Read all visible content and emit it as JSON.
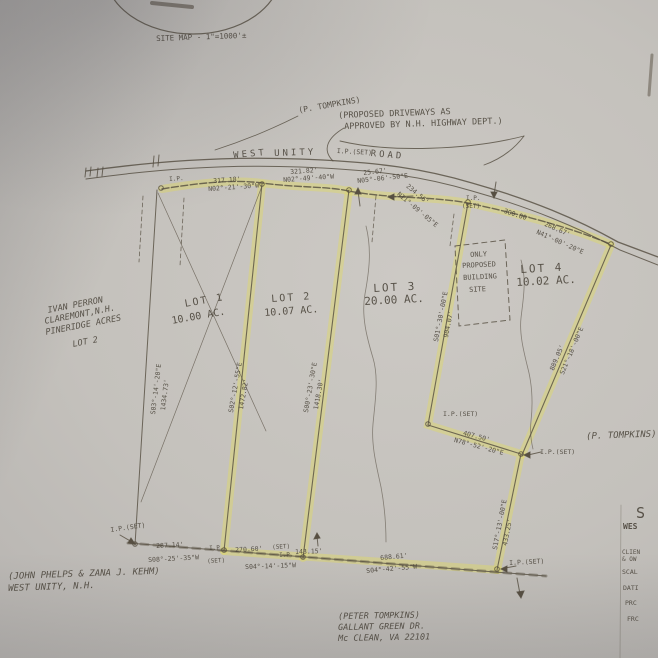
{
  "document": {
    "kind": "scanned land survey plat (photo of paper drawing)",
    "road_name": "WEST UNITY ROAD",
    "site_map_scale": "SITE MAP - 1\"=1000'±",
    "highlight_color": "#ddd76e",
    "ink_color": "#574f42",
    "lots": [
      {
        "lot": "LOT 1",
        "area": "10.00 AC."
      },
      {
        "lot": "LOT 2",
        "area": "10.07 AC."
      },
      {
        "lot": "LOT 3",
        "area": "20.00 AC."
      },
      {
        "lot": "LOT 4",
        "area": "10.02 AC."
      }
    ]
  },
  "labels": [
    {
      "name": "site-map-caption",
      "text": "SITE MAP - 1\"=1000'±",
      "x": 156,
      "y": 35,
      "rot": -2,
      "size": 7.5
    },
    {
      "name": "tompkins-note-top",
      "text": "(P. TOMPKINS)",
      "x": 298,
      "y": 107,
      "rot": -10,
      "size": 8
    },
    {
      "name": "driveway-note-line1",
      "text": "(PROPOSED DRIVEWAYS AS",
      "x": 338,
      "y": 112,
      "rot": -2,
      "size": 8.5
    },
    {
      "name": "driveway-note-line2",
      "text": "APPROVED BY N.H. HIGHWAY DEPT.)",
      "x": 344,
      "y": 123,
      "rot": -2,
      "size": 8.5
    },
    {
      "name": "road-label-west",
      "text": "WEST",
      "x": 233,
      "y": 152,
      "rot": -5,
      "size": 9,
      "cls": "ls3"
    },
    {
      "name": "road-label-unity",
      "text": "UNITY",
      "x": 274,
      "y": 150,
      "rot": -2,
      "size": 9,
      "cls": "ls3"
    },
    {
      "name": "road-ip-set",
      "text": "I.P.(SET)",
      "x": 337,
      "y": 148,
      "rot": 3,
      "size": 6.5
    },
    {
      "name": "road-label-road",
      "text": "ROAD",
      "x": 371,
      "y": 150,
      "rot": 5,
      "size": 9,
      "cls": "ls3"
    },
    {
      "name": "ip-marker-label",
      "text": "I.P.",
      "x": 169,
      "y": 177,
      "rot": -4,
      "size": 6
    },
    {
      "name": "frontage-dim-1",
      "text": "317.18'",
      "x": 213,
      "y": 178,
      "rot": -4,
      "size": 6.5
    },
    {
      "name": "frontage-brg-1",
      "text": "N02°-21'-30\"W",
      "x": 208,
      "y": 186,
      "rot": -4,
      "size": 6.5
    },
    {
      "name": "frontage-dim-2",
      "text": "321.82'",
      "x": 290,
      "y": 169,
      "rot": -4,
      "size": 6.5
    },
    {
      "name": "frontage-brg-2",
      "text": "N02°-49'-40\"W",
      "x": 283,
      "y": 177,
      "rot": -4,
      "size": 6.5
    },
    {
      "name": "frontage-dim-3",
      "text": "25.67'",
      "x": 363,
      "y": 170,
      "rot": -6,
      "size": 6.5
    },
    {
      "name": "frontage-brg-3",
      "text": "N05°-06'-50\"E",
      "x": 357,
      "y": 178,
      "rot": -6,
      "size": 6.5
    },
    {
      "name": "frontage-dim-4",
      "text": "234.56'",
      "x": 409,
      "y": 183,
      "rot": 40,
      "size": 6.5
    },
    {
      "name": "frontage-brg-4",
      "text": "N11°-09'-05\"E",
      "x": 400,
      "y": 191,
      "rot": 40,
      "size": 6.5
    },
    {
      "name": "ip-marker-label",
      "text": "I.P.",
      "x": 466,
      "y": 196,
      "rot": 0,
      "size": 6
    },
    {
      "name": "ip-marker-label",
      "text": "(SET)",
      "x": 462,
      "y": 204,
      "rot": 0,
      "size": 6
    },
    {
      "name": "frontage-dim-5",
      "text": "300.00'",
      "x": 505,
      "y": 208,
      "rot": 18,
      "size": 6.5
    },
    {
      "name": "frontage-dim-6",
      "text": "268.67'",
      "x": 546,
      "y": 221,
      "rot": 24,
      "size": 6.5
    },
    {
      "name": "frontage-brg-6",
      "text": "N41°-00'-20\"E",
      "x": 538,
      "y": 229,
      "rot": 24,
      "size": 6.5
    },
    {
      "name": "lot1-title",
      "text": "LOT 1",
      "x": 184,
      "y": 300,
      "rot": -10,
      "size": 10,
      "cls": "ls2"
    },
    {
      "name": "lot1-area",
      "text": "10.00 AC.",
      "x": 171,
      "y": 317,
      "rot": -10,
      "size": 10
    },
    {
      "name": "lot2-title",
      "text": "LOT 2",
      "x": 271,
      "y": 295,
      "rot": -4,
      "size": 10,
      "cls": "ls2"
    },
    {
      "name": "lot2-area",
      "text": "10.07 AC.",
      "x": 264,
      "y": 309,
      "rot": -4,
      "size": 10
    },
    {
      "name": "lot3-title",
      "text": "LOT 3",
      "x": 373,
      "y": 283,
      "rot": -3,
      "size": 11,
      "cls": "ls2"
    },
    {
      "name": "lot3-area",
      "text": "20.00 AC.",
      "x": 364,
      "y": 296,
      "rot": -3,
      "size": 11
    },
    {
      "name": "building-site-line1",
      "text": "ONLY",
      "x": 470,
      "y": 252,
      "rot": -3,
      "size": 7
    },
    {
      "name": "building-site-line2",
      "text": "PROPOSED",
      "x": 462,
      "y": 263,
      "rot": -3,
      "size": 7
    },
    {
      "name": "building-site-line3",
      "text": "BUILDING",
      "x": 463,
      "y": 275,
      "rot": -3,
      "size": 7
    },
    {
      "name": "building-site-line4",
      "text": "SITE",
      "x": 469,
      "y": 287,
      "rot": -3,
      "size": 7
    },
    {
      "name": "lot4-title",
      "text": "LOT 4",
      "x": 520,
      "y": 264,
      "rot": -3,
      "size": 11,
      "cls": "ls2"
    },
    {
      "name": "lot4-area",
      "text": "10.02 AC.",
      "x": 516,
      "y": 277,
      "rot": -3,
      "size": 11
    },
    {
      "name": "abutter-perron-1",
      "text": "IVAN PERRON",
      "x": 47,
      "y": 307,
      "rot": -11,
      "size": 8.5,
      "cls": "i"
    },
    {
      "name": "abutter-perron-2",
      "text": "CLAREMONT,N.H.",
      "x": 44,
      "y": 318,
      "rot": -11,
      "size": 8.5,
      "cls": "i"
    },
    {
      "name": "abutter-perron-3",
      "text": "PINERIDGE ACRES",
      "x": 45,
      "y": 329,
      "rot": -11,
      "size": 8.5,
      "cls": "i"
    },
    {
      "name": "abutter-perron-4",
      "text": "LOT 2",
      "x": 72,
      "y": 341,
      "rot": -11,
      "size": 8.5,
      "cls": "i"
    },
    {
      "name": "west-line-brg",
      "text": "S03°-14'-20\"E",
      "x": 150,
      "y": 414,
      "rot": -83,
      "size": 6.5
    },
    {
      "name": "west-line-dim",
      "text": "1434.73'",
      "x": 160,
      "y": 410,
      "rot": -83,
      "size": 6.5
    },
    {
      "name": "lot2-west-brg",
      "text": "S02°-12'-55\"E",
      "x": 228,
      "y": 412,
      "rot": -80,
      "size": 6.5
    },
    {
      "name": "lot2-west-dim",
      "text": "1472.82'",
      "x": 238,
      "y": 409,
      "rot": -80,
      "size": 6.5
    },
    {
      "name": "lot3-west-brg",
      "text": "S00°-23'-30\"E",
      "x": 303,
      "y": 412,
      "rot": -80,
      "size": 6.5
    },
    {
      "name": "lot3-west-dim",
      "text": "1418.30'",
      "x": 313,
      "y": 409,
      "rot": -80,
      "size": 6.5
    },
    {
      "name": "lot3-east-brg",
      "text": "S01°-30'-00\"E",
      "x": 433,
      "y": 341,
      "rot": -79,
      "size": 6.5
    },
    {
      "name": "lot3-east-dim",
      "text": "904.07'",
      "x": 443,
      "y": 337,
      "rot": -79,
      "size": 6.5
    },
    {
      "name": "ip-set-label",
      "text": "I.P.(SET)",
      "x": 443,
      "y": 411,
      "rot": 0,
      "size": 6.5
    },
    {
      "name": "jog-dim",
      "text": "407.50'",
      "x": 464,
      "y": 430,
      "rot": 15,
      "size": 6.5
    },
    {
      "name": "jog-brg",
      "text": "N78°-52'-20\"E",
      "x": 455,
      "y": 437,
      "rot": 15,
      "size": 6.5
    },
    {
      "name": "ip-set-label",
      "text": "I.P.(SET)",
      "x": 540,
      "y": 449,
      "rot": 0,
      "size": 6.5
    },
    {
      "name": "lot4-east-dim",
      "text": "889.05'",
      "x": 549,
      "y": 369,
      "rot": -67,
      "size": 6.5
    },
    {
      "name": "lot4-east-brg",
      "text": "S21°-18'-00\"E",
      "x": 559,
      "y": 373,
      "rot": -67,
      "size": 6.5
    },
    {
      "name": "tompkins-note-right",
      "text": "(P. TOMPKINS)",
      "x": 586,
      "y": 433,
      "rot": -2,
      "size": 9,
      "cls": "i"
    },
    {
      "name": "segment-brg",
      "text": "S17°-13'-00\"E",
      "x": 492,
      "y": 549,
      "rot": -79,
      "size": 6.5
    },
    {
      "name": "segment-dim",
      "text": "433.25'",
      "x": 502,
      "y": 545,
      "rot": -79,
      "size": 6.5
    },
    {
      "name": "ip-set-label",
      "text": "I.P.(SET)",
      "x": 110,
      "y": 527,
      "rot": -8,
      "size": 6.5
    },
    {
      "name": "bottom-dim-1",
      "text": "287.14'",
      "x": 156,
      "y": 543,
      "rot": -3,
      "size": 6.5
    },
    {
      "name": "bottom-brg-1",
      "text": "S08°-25'-35\"W",
      "x": 148,
      "y": 557,
      "rot": -3,
      "size": 6.5
    },
    {
      "name": "ip-marker-label",
      "text": "I.P.",
      "x": 209,
      "y": 546,
      "rot": -3,
      "size": 6
    },
    {
      "name": "ip-marker-label",
      "text": "(SET)",
      "x": 207,
      "y": 559,
      "rot": -3,
      "size": 6
    },
    {
      "name": "bottom-dim-2",
      "text": "270.60'",
      "x": 235,
      "y": 547,
      "rot": -3,
      "size": 6.5
    },
    {
      "name": "ip-marker-label",
      "text": "(SET)",
      "x": 272,
      "y": 545,
      "rot": -3,
      "size": 6
    },
    {
      "name": "ip-marker-label",
      "text": "I.P.",
      "x": 279,
      "y": 553,
      "rot": -3,
      "size": 6
    },
    {
      "name": "bottom-dim-3",
      "text": "143.15'",
      "x": 295,
      "y": 549,
      "rot": -2,
      "size": 6.5
    },
    {
      "name": "bottom-brg-2",
      "text": "S04°-14'-15\"W",
      "x": 245,
      "y": 564,
      "rot": -2,
      "size": 6.5
    },
    {
      "name": "bottom-dim-4",
      "text": "688.61'",
      "x": 380,
      "y": 555,
      "rot": -5,
      "size": 6.5
    },
    {
      "name": "bottom-brg-3",
      "text": "S04°-42'-55\"W",
      "x": 366,
      "y": 568,
      "rot": -5,
      "size": 6.5
    },
    {
      "name": "ip-set-label",
      "text": "I.P.(SET)",
      "x": 509,
      "y": 560,
      "rot": -3,
      "size": 6.5
    },
    {
      "name": "abutter-phelps-1",
      "text": "(JOHN PHELPS & ZANA J. KEHM)",
      "x": 8,
      "y": 573,
      "rot": -2,
      "size": 9,
      "cls": "i"
    },
    {
      "name": "abutter-phelps-2",
      "text": "WEST UNITY, N.H.",
      "x": 8,
      "y": 585,
      "rot": -2,
      "size": 9,
      "cls": "i"
    },
    {
      "name": "owner-tompkins-1",
      "text": "(PETER TOMPKINS)",
      "x": 338,
      "y": 613,
      "rot": -1,
      "size": 8.5,
      "cls": "i"
    },
    {
      "name": "owner-tompkins-2",
      "text": "GALLANT GREEN DR.",
      "x": 338,
      "y": 624,
      "rot": -1,
      "size": 8.5,
      "cls": "i"
    },
    {
      "name": "owner-tompkins-3",
      "text": "Mc CLEAN, VA 22101",
      "x": 338,
      "y": 635,
      "rot": -1,
      "size": 8.5,
      "cls": "i"
    },
    {
      "name": "titleblock-s",
      "text": "S",
      "x": 636,
      "y": 506,
      "rot": 0,
      "size": 15
    },
    {
      "name": "titleblock-wes",
      "text": "WES",
      "x": 623,
      "y": 523,
      "rot": 0,
      "size": 8,
      "cls": "b"
    },
    {
      "name": "titleblock-clien",
      "text": "CLIEN",
      "x": 622,
      "y": 550,
      "rot": 0,
      "size": 6
    },
    {
      "name": "titleblock-ow",
      "text": "& OW",
      "x": 622,
      "y": 557,
      "rot": 0,
      "size": 6
    },
    {
      "name": "titleblock-scal",
      "text": "SCAL",
      "x": 622,
      "y": 569,
      "rot": 0,
      "size": 6.5
    },
    {
      "name": "titleblock-dati",
      "text": "DATI",
      "x": 623,
      "y": 585,
      "rot": 0,
      "size": 6.5
    },
    {
      "name": "titleblock-prc",
      "text": "PRC",
      "x": 625,
      "y": 600,
      "rot": 0,
      "size": 6.5
    },
    {
      "name": "titleblock-frc",
      "text": "FRC",
      "x": 627,
      "y": 616,
      "rot": 0,
      "size": 6.5
    }
  ]
}
